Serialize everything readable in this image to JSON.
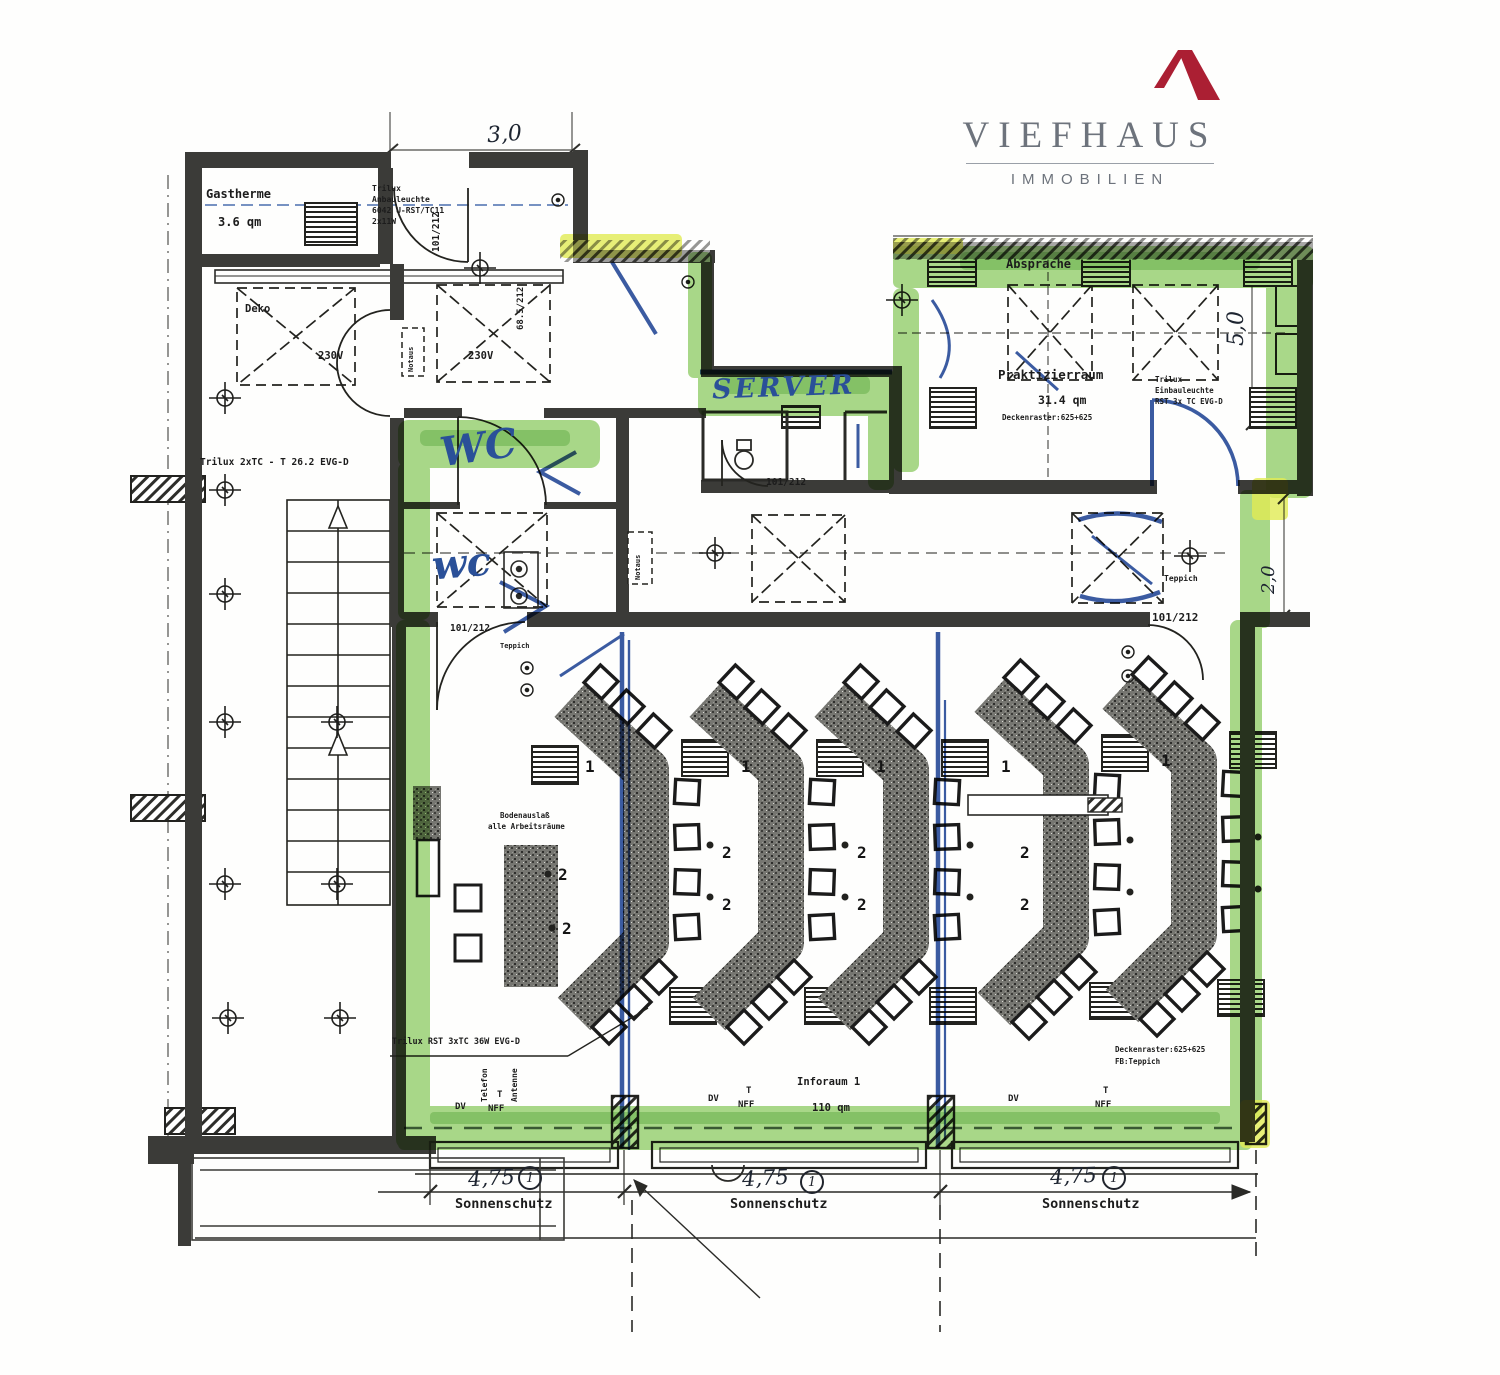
{
  "logo": {
    "name": "VIEFHAUS",
    "subtitle": "IMMOBILIEN"
  },
  "colors": {
    "highlight_green": "#7cc458",
    "highlight_yellow": "#e2ec55",
    "pen_blue": "#2a5098",
    "wall": "#3b3b38",
    "logo_red": "#ab1f33",
    "logo_gray": "#6d737c"
  },
  "rooms": {
    "gastherme": "Gastherme",
    "gastherme_qm": "3.6 qm",
    "deko": "Deko",
    "absprache": "Absprache",
    "praktizierraum": "Praktizierraum",
    "praktizierraum_qm": "31.4 qm",
    "praktizierraum_note": "Deckenraster:625+625",
    "inforaum": "Inforaum 1",
    "inforaum_qm": "110 qm"
  },
  "handwritten": {
    "server": "SERVER",
    "wc": "WC",
    "wc2": "wc",
    "dim_top": "3,0",
    "dim_right": "5,0",
    "dim_right2": "2,0",
    "dim_win": "4,75",
    "circle_num": "1"
  },
  "labels": {
    "v230": "230V",
    "notaus": "Notaus",
    "teppich": "Teppich",
    "door101": "101/212",
    "door685": "68.5/212",
    "trilux_left": "Trilux 2xTC - T 26.2 EVG-D",
    "trilux_bottom": "Trilux RST 3xTC 36W EVG-D",
    "trilux_anbau_1": "Trilux",
    "trilux_anbau_2": "Anbauleuchte",
    "trilux_anbau_3": "6042 U-RST/TC11",
    "trilux_anbau_4": "2x11W",
    "trilux_einbau_1": "Trilux",
    "trilux_einbau_2": "Einbauleuchte",
    "trilux_einbau_3": "RST 3x TC EVG-D",
    "boden_1": "Bodenauslaß",
    "boden_2": "alle Arbeitsräume",
    "deckenraster": "Deckenraster:625+625",
    "fb_teppich": "FB:Teppich",
    "dv": "DV",
    "t": "T",
    "nff": "NFF",
    "telefon": "Telefon",
    "antenne": "Antenne",
    "sonnenschutz": "Sonnenschutz",
    "n1": "1",
    "n2": "2"
  }
}
